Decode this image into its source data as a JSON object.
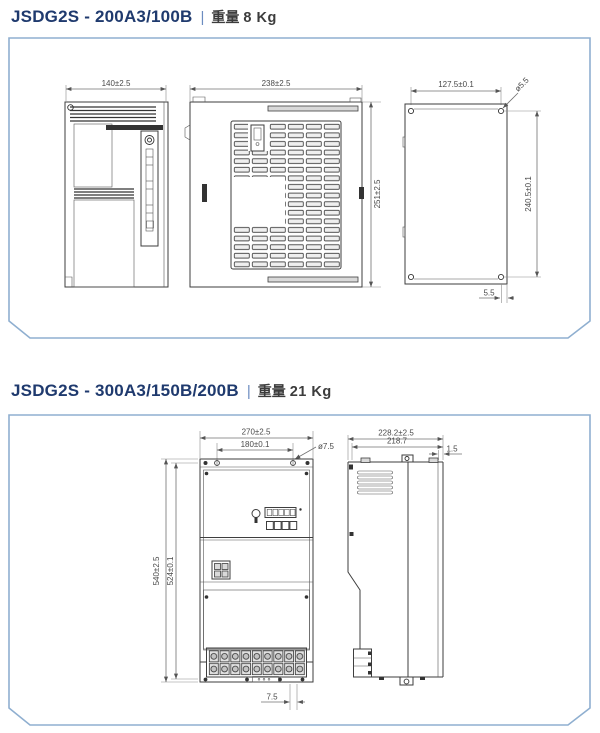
{
  "page": {
    "panel_border_color": "#8fafd0",
    "title_color": "#1f3a6e"
  },
  "sections": [
    {
      "model": "JSDG2S - 200A3/100B",
      "separator": "|",
      "weight_label": "重量",
      "weight_value": "8 Kg",
      "views": {
        "front": {
          "width": "140±2.5"
        },
        "side": {
          "width": "238±2.5",
          "height": "251±2.5"
        },
        "plate": {
          "hole_pitch_w": "127.5±0.1",
          "hole_dia": "ø5.5",
          "hole_pitch_h": "240.5±0.1",
          "edge_offset": "5.5"
        }
      }
    },
    {
      "model": "JSDG2S - 300A3/150B/200B",
      "separator": "|",
      "weight_label": "重量",
      "weight_value": "21 Kg",
      "views": {
        "front": {
          "width": "270±2.5",
          "hole_pitch_w": "180±0.1",
          "hole_dia": "ø7.5",
          "height": "540±2.5",
          "hole_pitch_h": "524±0.1",
          "bottom_offset": "7.5"
        },
        "side": {
          "depth": "228.2±2.5",
          "depth_inner": "218.7",
          "flange": "1.5"
        }
      }
    }
  ]
}
